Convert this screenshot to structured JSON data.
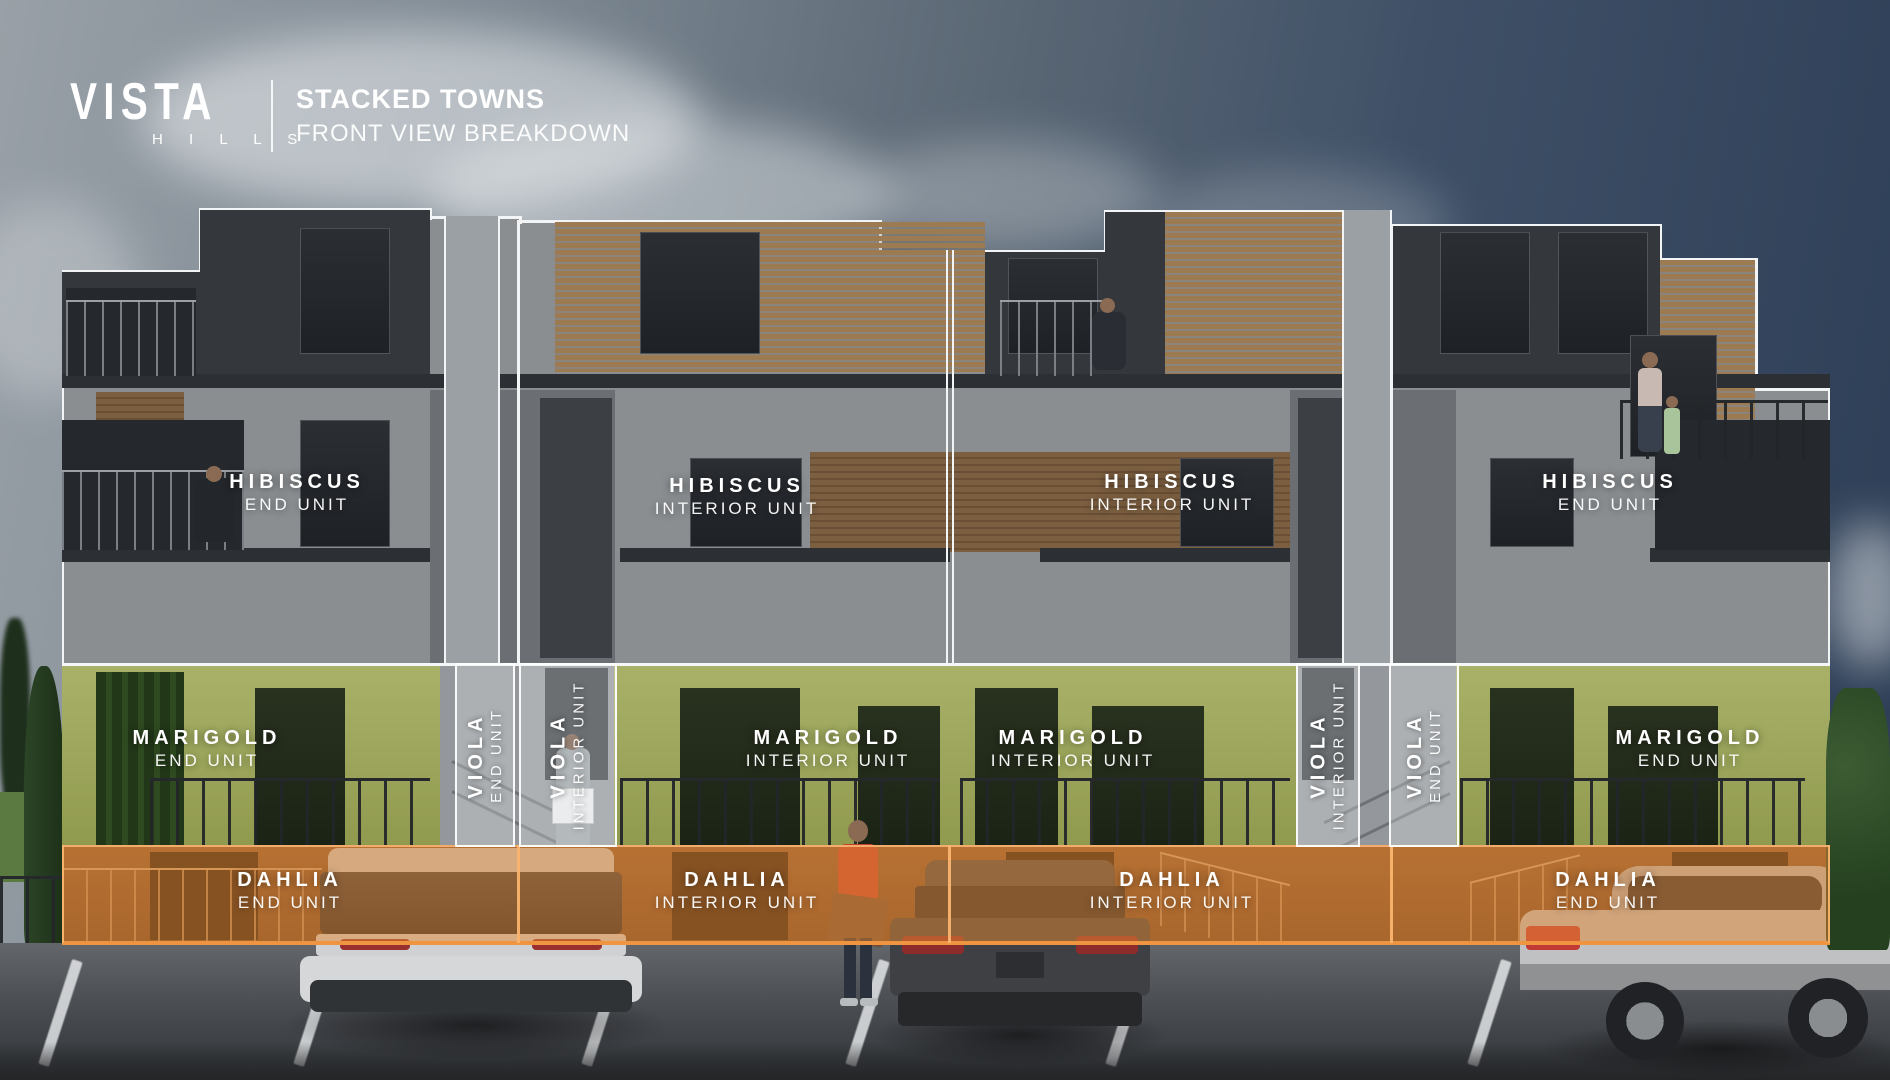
{
  "header": {
    "brand_top": "VISTA",
    "brand_bottom": "H I L L S",
    "title": "STACKED TOWNS",
    "subtitle": "FRONT VIEW BREAKDOWN"
  },
  "units": {
    "hibiscus": [
      {
        "name": "HIBISCUS",
        "type": "END UNIT"
      },
      {
        "name": "HIBISCUS",
        "type": "INTERIOR UNIT"
      },
      {
        "name": "HIBISCUS",
        "type": "INTERIOR UNIT"
      },
      {
        "name": "HIBISCUS",
        "type": "END UNIT"
      }
    ],
    "marigold": [
      {
        "name": "MARIGOLD",
        "type": "END UNIT"
      },
      {
        "name": "MARIGOLD",
        "type": "INTERIOR UNIT"
      },
      {
        "name": "MARIGOLD",
        "type": "INTERIOR UNIT"
      },
      {
        "name": "MARIGOLD",
        "type": "END UNIT"
      }
    ],
    "viola": [
      {
        "name": "VIOLA",
        "type": "END UNIT"
      },
      {
        "name": "VIOLA",
        "type": "INTERIOR UNIT"
      },
      {
        "name": "VIOLA",
        "type": "INTERIOR UNIT"
      },
      {
        "name": "VIOLA",
        "type": "END UNIT"
      }
    ],
    "dahlia": [
      {
        "name": "DAHLIA",
        "type": "END UNIT"
      },
      {
        "name": "DAHLIA",
        "type": "INTERIOR UNIT"
      },
      {
        "name": "DAHLIA",
        "type": "INTERIOR UNIT"
      },
      {
        "name": "DAHLIA",
        "type": "END UNIT"
      }
    ]
  },
  "colors": {
    "marigold_green": "#9aa45c",
    "dahlia_orange": "#d0803c",
    "viola_overlay_border": "#ffffff",
    "label_text": "#ffffff"
  }
}
